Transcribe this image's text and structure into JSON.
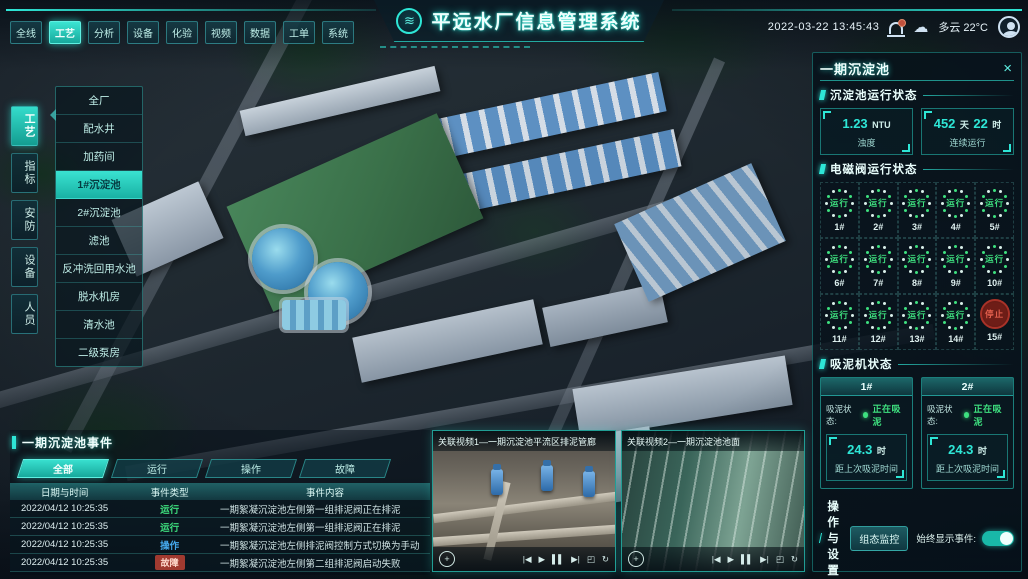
{
  "colors": {
    "accent": "#2ee6d6",
    "green": "#3ee07f",
    "red": "#e05555",
    "blue": "#45a8ec"
  },
  "topbar": {
    "tabs": [
      "全线",
      "工艺",
      "分析",
      "设备",
      "化验",
      "视频",
      "数据",
      "工单",
      "系统"
    ],
    "active_tab": "工艺",
    "title": "平远水厂信息管理系统",
    "datetime": "2022-03-22 13:45:43",
    "weather": "多云 22°C",
    "cloud_glyph": "☁",
    "logo_glyph": "≋"
  },
  "sidebar": {
    "tabs": [
      "工艺",
      "指标",
      "安防",
      "设备",
      "人员"
    ],
    "active_tab": "工艺",
    "submenu": [
      "全厂",
      "配水井",
      "加药间",
      "1#沉淀池",
      "2#沉淀池",
      "滤池",
      "反冲洗回用水池",
      "脱水机房",
      "清水池",
      "二级泵房"
    ],
    "active_item": "1#沉淀池"
  },
  "panel": {
    "title": "一期沉淀池",
    "close_glyph": "×",
    "status": {
      "title": "沉淀池运行状态",
      "turbidity": {
        "value": "1.23",
        "unit": "NTU",
        "label": "浊度"
      },
      "runtime": {
        "v1": "452",
        "u1": "天",
        "v2": "22",
        "u2": "时",
        "label": "连续运行"
      }
    },
    "valves": {
      "title": "电磁阀运行状态",
      "items": [
        {
          "id": "1#",
          "status": "运行"
        },
        {
          "id": "2#",
          "status": "运行"
        },
        {
          "id": "3#",
          "status": "运行"
        },
        {
          "id": "4#",
          "status": "运行"
        },
        {
          "id": "5#",
          "status": "运行"
        },
        {
          "id": "6#",
          "status": "运行"
        },
        {
          "id": "7#",
          "status": "运行"
        },
        {
          "id": "8#",
          "status": "运行"
        },
        {
          "id": "9#",
          "status": "运行"
        },
        {
          "id": "10#",
          "status": "运行"
        },
        {
          "id": "11#",
          "status": "运行"
        },
        {
          "id": "12#",
          "status": "运行"
        },
        {
          "id": "13#",
          "status": "运行"
        },
        {
          "id": "14#",
          "status": "运行"
        },
        {
          "id": "15#",
          "status": "停止"
        }
      ]
    },
    "mud": {
      "title": "吸泥机状态",
      "machines": [
        {
          "id": "1#",
          "status_label": "吸泥状态:",
          "status": "正在吸泥",
          "value": "24.3",
          "unit": "时",
          "label": "距上次吸泥时间"
        },
        {
          "id": "2#",
          "status_label": "吸泥状态:",
          "status": "正在吸泥",
          "value": "24.3",
          "unit": "时",
          "label": "距上次吸泥时间"
        }
      ]
    },
    "ops": {
      "title": "操作与设置",
      "button": "组态监控",
      "toggle_label": "始终显示事件:",
      "toggle_on": true
    }
  },
  "events": {
    "title": "一期沉淀池事件",
    "tabs": [
      "全部",
      "运行",
      "操作",
      "故障"
    ],
    "active_tab": "全部",
    "columns": [
      "日期与时间",
      "事件类型",
      "事件内容"
    ],
    "rows": [
      {
        "time": "2022/04/12 10:25:35",
        "type": "运行",
        "content": "一期絮凝沉淀池左侧第一组排泥阀正在排泥"
      },
      {
        "time": "2022/04/12 10:25:35",
        "type": "运行",
        "content": "一期絮凝沉淀池左侧第一组排泥阀正在排泥"
      },
      {
        "time": "2022/04/12 10:25:35",
        "type": "操作",
        "content": "一期絮凝沉淀池左侧排泥阀控制方式切换为手动"
      },
      {
        "time": "2022/04/12 10:25:35",
        "type": "故障",
        "content": "一期絮凝沉淀池左侧第二组排泥阀启动失败"
      }
    ]
  },
  "videos": {
    "items": [
      {
        "title": "关联视频1—一期沉淀池平流区排泥管廊"
      },
      {
        "title": "关联视频2—一期沉淀池池面"
      }
    ],
    "controls": {
      "dpad": "+",
      "prev": "|◀",
      "play": "▶",
      "pause": "▌▌",
      "next": "▶|",
      "fullscreen": "◰",
      "loop": "↻"
    }
  }
}
